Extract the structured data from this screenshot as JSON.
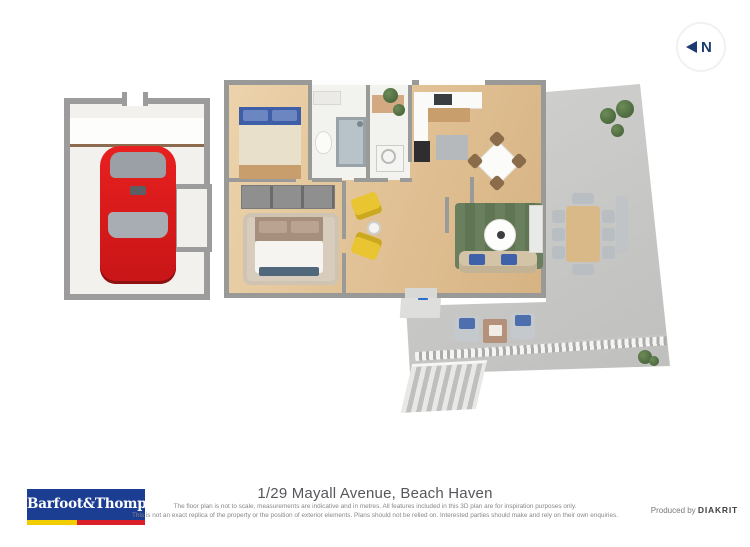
{
  "compass": {
    "label": "N"
  },
  "icons": {
    "compass": "left-arrow-with-N",
    "entrance": "up-arrow"
  },
  "colors": {
    "entrance_arrow_blue": "#2a70c8",
    "car_red": "#e31b1d",
    "living_rug_green": "#66805c",
    "armchair_yellow": "#e7c431",
    "bed_blue": "#3e5ea7",
    "wall_gray": "#9a9a98",
    "deck_gray": "#c7c7c5",
    "wood_floor": "#e0c094",
    "compass_navy": "#1d3a70",
    "logo_blue": "#1c3e92",
    "logo_stripe_yellow": "#f2cd00",
    "logo_stripe_red": "#d81f2a"
  },
  "footer": {
    "logo": {
      "text": "Barfoot&Thompson"
    },
    "title": "1/29 Mayall Avenue, Beach Haven",
    "disclaimer_line1": "The floor plan is not to scale, measurements are indicative and in metres. All features included in this 3D plan are for inspiration purposes only.",
    "disclaimer_line2": "This is not an exact replica of the property or the position of exterior elements. Plans should not be relied on. Interested parties should make and rely on their own enquiries.",
    "produced_by": "Produced by",
    "producer": "DIAKRIT"
  }
}
